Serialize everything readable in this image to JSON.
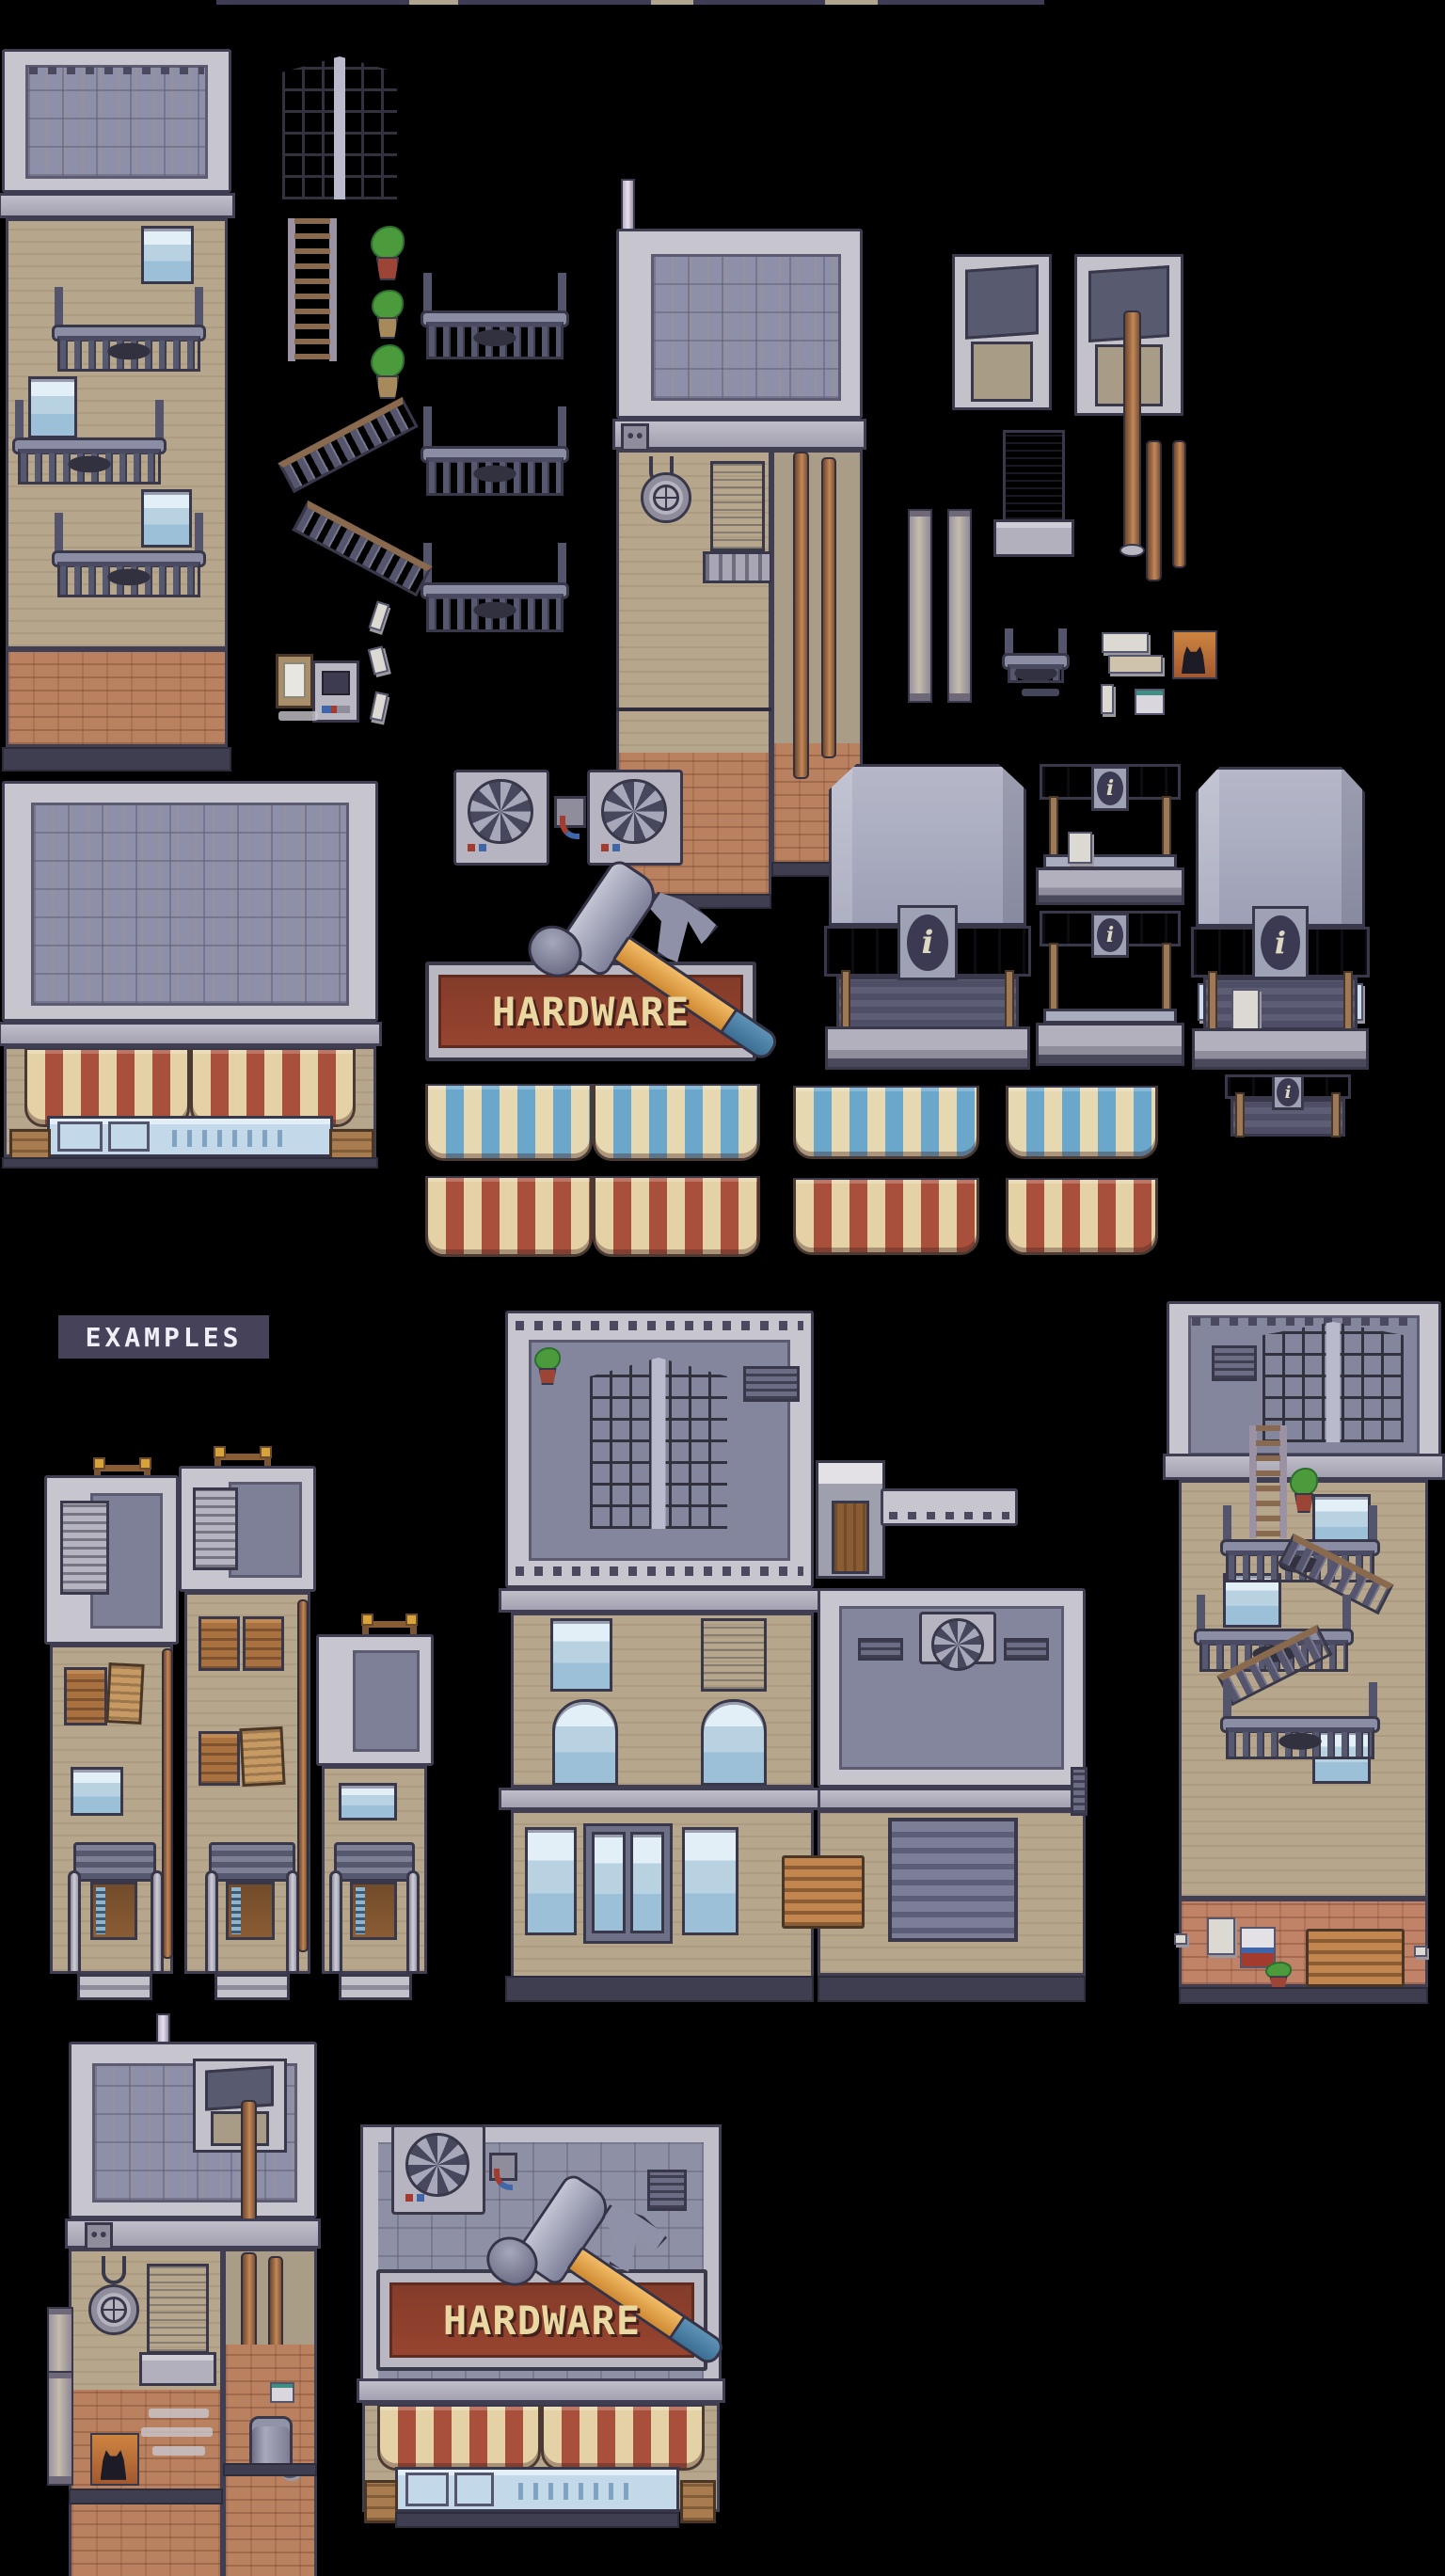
{
  "meta": {
    "image_type": "pixel-art city-buildings tileset sheet",
    "background": "#000000",
    "note": "Top edge shows only the bottom sliver of a cropped-off title"
  },
  "labels": {
    "examples": "EXAMPLES",
    "hardware": "HARDWARE",
    "info": "i"
  },
  "palette": {
    "outline": "#39384a",
    "roof_frame": "#c7c5cd",
    "roof_slate": "#8e90aa",
    "wall_tan": "#b6a68c",
    "brick": "#b9815f",
    "metal_dark": "#55566e",
    "metal_light": "#9fa1b6",
    "glass": "#9cc0d8",
    "wood": "#a9713f",
    "rust": "#a8724a",
    "awning_red": "#a8503c",
    "awning_blue": "#6ba7cb",
    "awning_cream": "#e4d2a6",
    "sign_red": "#96442f",
    "sign_text": "#ead8a2",
    "hammer_handle": "#e8a64f",
    "hammer_grip": "#4a7fa3",
    "label_bg": "#45425a",
    "plant_green": "#4b9b3c"
  },
  "tileset_sprites": [
    "apartment-building-with-fire-escapes",
    "corner-glass-stairwell",
    "ladder",
    "potted-plants",
    "fire-escape-balcony-railings",
    "fire-escape-stairs",
    "notice-clipboard",
    "ticket-machine",
    "litter-scraps",
    "flat-roof-building-with-porthole-window",
    "roof-antenna",
    "dormer-skylights",
    "rusty-pipes",
    "downspout-pillars",
    "window-with-planter",
    "small-balcony-rail",
    "newspapers",
    "black-cat-poster",
    "mini-vent-box",
    "large-storefront-roof",
    "ac-fan-units",
    "pipe-valve",
    "hardware-sign-with-hammer",
    "info-kiosk-large",
    "info-kiosk-counters",
    "info-kiosk-back",
    "blue-striped-awnings",
    "red-striped-awnings"
  ],
  "example_builds": [
    "three-row-houses-with-stoops",
    "corner-commercial-building-with-garage-and-bench",
    "apartment-with-zigzag-fire-escape",
    "porthole-building-with-trash-can-and-cat-poster",
    "hardware-store-front"
  ]
}
